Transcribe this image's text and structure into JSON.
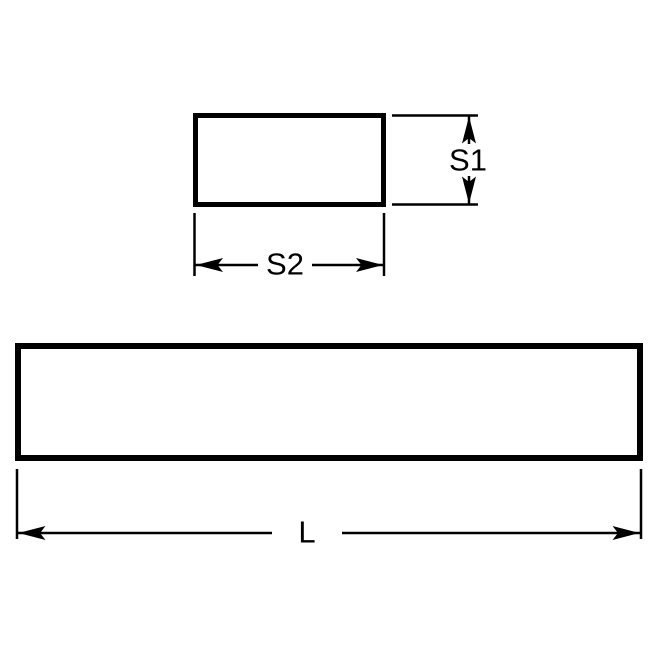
{
  "drawing": {
    "labels": {
      "height": "S1",
      "width": "S2",
      "length": "L"
    },
    "colors": {
      "line": "#000000",
      "background": "#ffffff"
    }
  }
}
